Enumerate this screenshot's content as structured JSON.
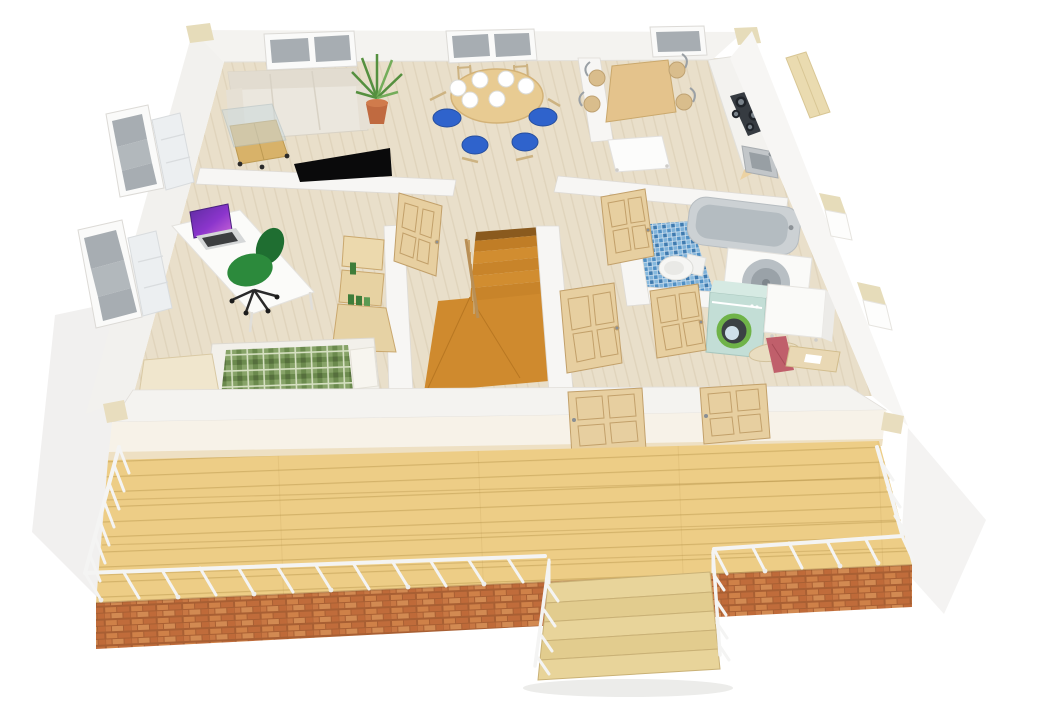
{
  "scene": {
    "type": "3d-floor-plan-render",
    "description": "Top-down 3D render of a furnished single-storey home with a large wooden terrace, white railing, brick base and front steps. No text is rendered in the image.",
    "rooms": [
      {
        "name": "living-room",
        "objects": [
          "cream-sofa",
          "glass-coffee-table",
          "potted-palm",
          "wall-mounted-tv",
          "double-window"
        ]
      },
      {
        "name": "dining-area",
        "objects": [
          "round-wood-table",
          "six-white-plates",
          "blue-seat-chairs",
          "double-window"
        ]
      },
      {
        "name": "kitchen",
        "objects": [
          "wood-table",
          "metal-frame-chairs",
          "counter-cabinets",
          "dark-cooktop",
          "corner-sink",
          "white-side-table",
          "window"
        ]
      },
      {
        "name": "bathroom",
        "objects": [
          "bathtub",
          "toilet",
          "round-basin-unit",
          "blue-mosaic-floor"
        ]
      },
      {
        "name": "utility-room",
        "objects": [
          "mint-washing-machine",
          "white-cabinet",
          "ironing-board",
          "pink-cloth",
          "small-desk"
        ]
      },
      {
        "name": "bedroom-office",
        "objects": [
          "white-desk",
          "laptop-purple-screen",
          "green-office-chair",
          "shelving-unit",
          "bed-green-plaid",
          "side-cabinet",
          "two-windows",
          "radiators"
        ]
      },
      {
        "name": "hallway",
        "objects": [
          "wood-staircase",
          "stair-landing",
          "banister",
          "open-panel-doors"
        ]
      }
    ],
    "exterior": [
      "wooden-terrace",
      "white-railing",
      "brick-base",
      "front-steps",
      "terrace-doors",
      "corner-caps"
    ]
  },
  "colors": {
    "background": "#ffffff",
    "ground_shadow": "#f1f0ef",
    "wall_top": "#f4f3f0",
    "wall_inner": "#f7f6f4",
    "wall_front_face": "#f7f2e8",
    "wall_trim_beige": "#e6dcba",
    "floor_wood": "#e9dfca",
    "floor_seam": "#cdbfa4",
    "deck_wood": "#edcd86",
    "deck_seam": "#b08c40",
    "brick": "#c97c46",
    "brick_mortar": "#a85f33",
    "railing_white": "#f4f4f3",
    "step_wood": "#e8d49a",
    "step_wood_dark": "#e2cc8e",
    "stair_wood": "#cf8a2e",
    "stair_tread": "#c8842a",
    "stair_tread_light": "#d18d30",
    "door_wood": "#e7cfa0",
    "door_edge": "#c2a06a",
    "sofa": "#ebe7de",
    "coffee_table_wood": "#d8b269",
    "glass": "#ccd9dc",
    "plant_green": "#55903f",
    "plant_pot": "#c06a40",
    "tv_black": "#0a0a0b",
    "dining_table": "#e8cb92",
    "chair_blue": "#2f63cc",
    "plate_white": "#ffffff",
    "kitchen_cabinet": "#ecd2a2",
    "cooktop": "#363b41",
    "steel": "#c2c6c9",
    "tile_blue": "#4f8fc4",
    "tub_gray": "#ccd1d4",
    "tub_inner": "#b4bcc1",
    "porcelain": "#f6f6f4",
    "washer_mint": "#c3ded6",
    "washer_door_green": "#6fb348",
    "cloth_pink": "#c05f6b",
    "board_tan": "#e9ddc0",
    "desk_white": "#fbfbf9",
    "laptop_purple": "#8b35cc",
    "chair_green": "#2c8a3c",
    "shelf_wood": "#ecd9ad",
    "shelf_items_green": "#3f7d3a",
    "plaid_green": "#87a368",
    "plaid_dark": "#6b8a4d",
    "plaid_light": "#d6e0c2",
    "bed_frame": "#f2f0ea",
    "radiator": "#eceff1",
    "window_glass": "#a7adb2",
    "window_frame": "#fafaf9"
  }
}
